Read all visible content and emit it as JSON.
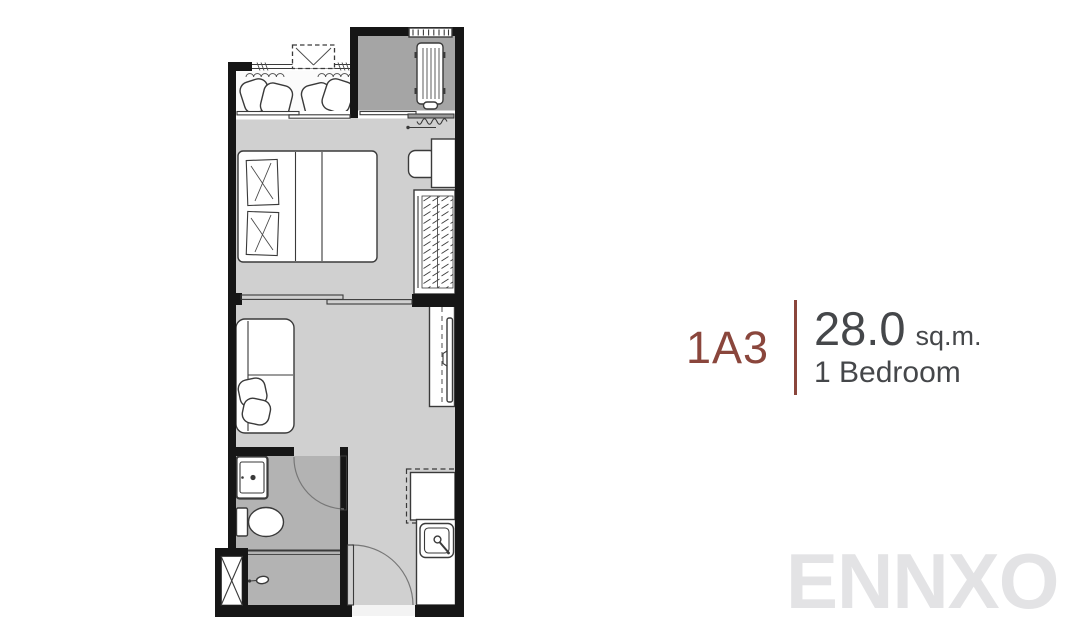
{
  "unit": {
    "code": "1A3",
    "area_value": "28.0",
    "area_unit": "sq.m.",
    "bedrooms": "1 Bedroom"
  },
  "watermark": "ENNXO",
  "colors": {
    "unit_code": "#8a463c",
    "divider_line": "#8a463c",
    "text": "#45474a",
    "watermark": "#e3e3e5",
    "wall": "#161616",
    "floor_main": "#d0d0d0",
    "floor_bathroom": "#b3b3b3",
    "floor_ac_ledge": "#a5a5a5",
    "floor_balcony": "#fbfbfb",
    "threshold": "#f3f3f3",
    "furniture_fill": "#ffffff",
    "furniture_stroke": "#3a3a3a"
  },
  "floor_plan": {
    "rooms": [
      {
        "name": "balcony"
      },
      {
        "name": "ac-ledge"
      },
      {
        "name": "bedroom"
      },
      {
        "name": "living-room"
      },
      {
        "name": "bathroom"
      },
      {
        "name": "entrance-kitchen"
      }
    ],
    "furniture": [
      "lounge-chairs",
      "condenser-unit",
      "ac-unit",
      "vent-louver",
      "curtain",
      "double-bed",
      "pillows",
      "wardrobe",
      "desk",
      "stool",
      "sofa",
      "sofa-cushions",
      "tv",
      "tv-console",
      "sliding-door",
      "vanity-sink",
      "toilet",
      "shower-head",
      "pipe-shaft",
      "refrigerator",
      "kitchen-sink",
      "kitchen-counter",
      "bathroom-door",
      "entrance-door"
    ]
  }
}
